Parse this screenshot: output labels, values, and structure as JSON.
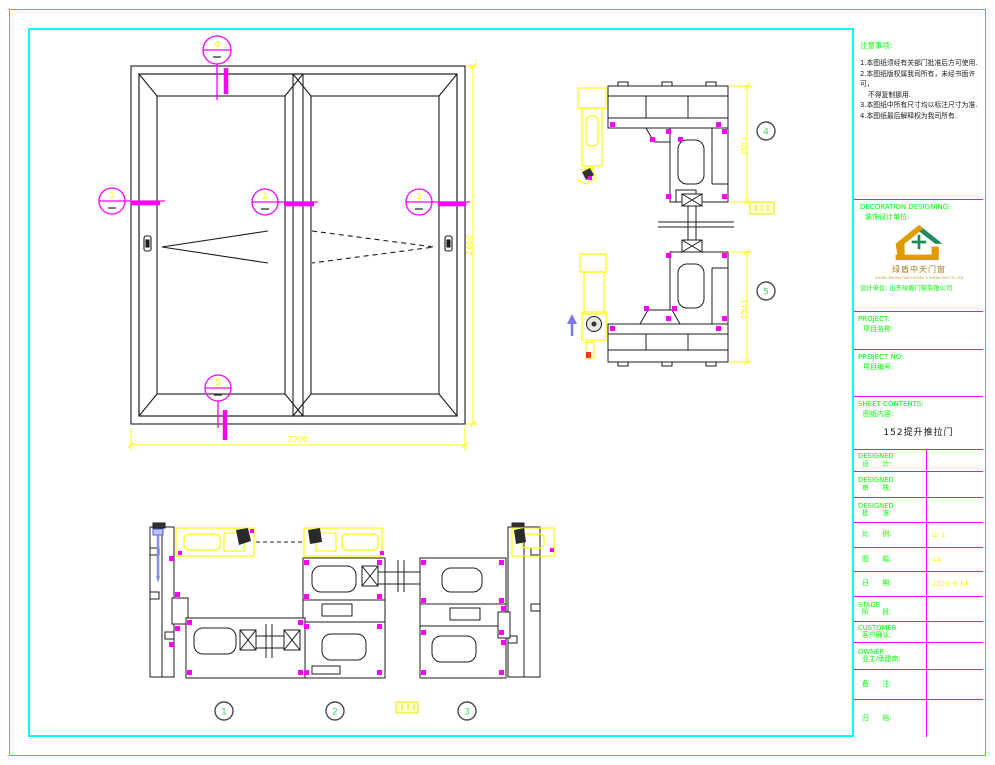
{
  "colors": {
    "frame_green": "#00ff00",
    "frame_cyan": "#00ffff",
    "divider_magenta": "#ff00ff",
    "dim_yellow": "#ffff00",
    "label_green": "#00ff00",
    "detail_number_green": "#3fd96a"
  },
  "notes": {
    "title": "注意事项:",
    "lines": [
      "1.本图纸须经有关部门批准后方可使用.",
      "2.本图纸版权属我司所有，未经书面许可，",
      "不得复制挪用.",
      "3.本图纸中所有尺寸均以标注尺寸为准.",
      "4.本图纸最后解释权为我司所有."
    ]
  },
  "decoration": {
    "title_en": "DECORATION DESIGNING:",
    "title_cn": "装饰设计单位:",
    "logo_name": "绿盾中天门窗",
    "logo_sub": "LVDUN ZHONGTIAN DOORS & WINDOWS CO.,LTD",
    "design_unit": "设计单位: 山东绿盾门窗有限公司"
  },
  "project": {
    "label_en": "PROJECT:",
    "label_cn": "项目名称:"
  },
  "project_no": {
    "label_en": "PROJECT NO:",
    "label_cn": "项目编号:"
  },
  "sheet": {
    "label_en": "SHEET CONTENTS:",
    "label_cn": "图纸内容:",
    "value": "152提升推拉门"
  },
  "rows": [
    {
      "en": "DESIGNED",
      "cn": "设　　计:",
      "value": ""
    },
    {
      "en": "DESIGNED",
      "cn": "审　　核:",
      "value": ""
    },
    {
      "en": "DESIGNED",
      "cn": "批　　准:",
      "value": ""
    },
    {
      "en": "",
      "cn": "比　　例:",
      "value": "1: 1"
    },
    {
      "en": "",
      "cn": "图　　幅:",
      "value": "A4"
    },
    {
      "en": "",
      "cn": "日　　期:",
      "value": "2020-9-14"
    },
    {
      "en": "STAGE",
      "cn": "阶　　段:",
      "value": ""
    },
    {
      "en": "CUSTOMER",
      "cn": "客户确认:",
      "value": ""
    },
    {
      "en": "OWNER",
      "cn": "业主/承建商:",
      "value": ""
    },
    {
      "en": "",
      "cn": "备　　注:",
      "value": ""
    },
    {
      "en": "",
      "cn": "归　　档:",
      "value": ""
    }
  ],
  "elevation": {
    "dim_width": "2200",
    "dim_height": "2400",
    "marker_top": "4",
    "marker_left": "1",
    "marker_center": "2",
    "marker_right": "3",
    "marker_bottom": "5"
  },
  "details": {
    "bubble_top": "4",
    "bubble_bottom": "5",
    "dim_top": "150.1",
    "dim_bottom": "150.1",
    "bubble_1": "1",
    "bubble_2": "2",
    "bubble_3": "3"
  }
}
